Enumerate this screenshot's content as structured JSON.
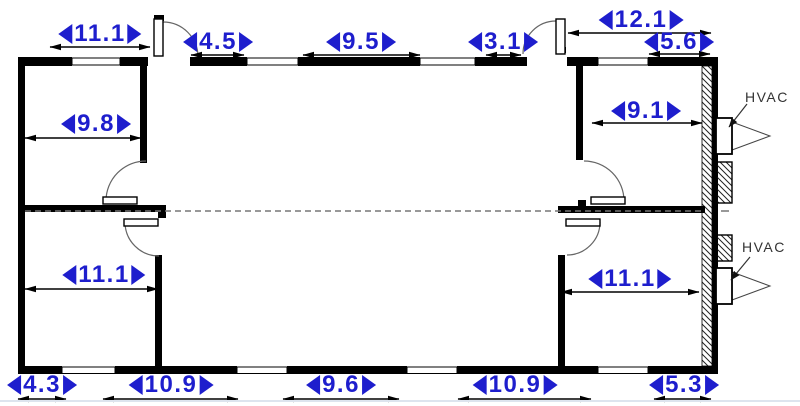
{
  "drawing": {
    "type": "floor-plan",
    "dimensions": {
      "top_left_room_width": "11.1",
      "top_left_door_span": "4.5",
      "top_center_span": "9.5",
      "top_right_door_span": "3.1",
      "top_right_overall": "12.1",
      "top_right_span": "5.6",
      "top_left_room_interior": "9.8",
      "top_right_room_interior": "9.1",
      "bottom_left_room_interior": "11.1",
      "bottom_right_room_interior": "11.1",
      "bottom_span_1": "4.3",
      "bottom_span_2": "10.9",
      "bottom_span_3": "9.6",
      "bottom_span_4": "10.9",
      "bottom_span_5": "5.3"
    },
    "labels": {
      "hvac_upper": "HVAC",
      "hvac_lower": "HVAC"
    },
    "colors": {
      "dimension_text": "#1e1ecd",
      "walls": "#000000",
      "door_arc": "#666666",
      "hvac_text": "#333333"
    }
  }
}
